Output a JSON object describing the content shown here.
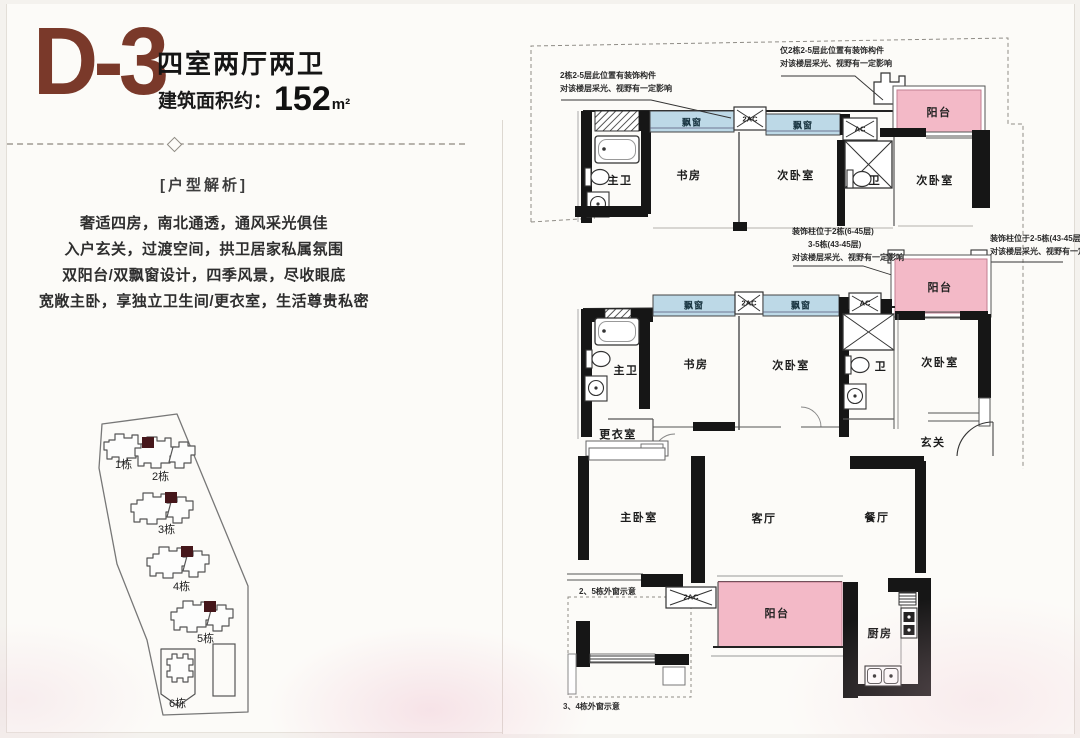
{
  "header": {
    "unit_code": "D-3",
    "unit_type": "四室两厅两卫",
    "area_label": "建筑面积约：",
    "area_value": "152",
    "area_unit": "m²"
  },
  "analysis": {
    "title": "[户型解析]",
    "lines": [
      "奢适四房，南北通透，通风采光俱佳",
      "入户玄关，过渡空间，拱卫居家私属氛围",
      "双阳台/双飘窗设计，四季风景，尽收眼底",
      "宽敞主卧，享独立卫生间/更衣室，生活尊贵私密"
    ]
  },
  "site_plan": {
    "buildings": [
      "1栋",
      "2栋",
      "3栋",
      "4栋",
      "5栋",
      "6栋"
    ]
  },
  "floor_plan": {
    "rooms": {
      "master_bath": "主卫",
      "study": "书房",
      "secondary_bedroom": "次卧室",
      "bath": "卫",
      "balcony": "阳台",
      "dressing_room": "更衣室",
      "foyer": "玄关",
      "master_bedroom": "主卧室",
      "living_room": "客厅",
      "dining_room": "餐厅",
      "kitchen": "厨房"
    },
    "features": {
      "bay_window": "飘窗",
      "ac_double": "2AC",
      "ac": "AC"
    },
    "annotations": {
      "top": [
        "2栋2-5层此位置有装饰构件",
        "对该楼层采光、视野有一定影响"
      ],
      "top_right": [
        "仅2栋2-5层此位置有装饰构件",
        "对该楼层采光、视野有一定影响"
      ],
      "mid_left": [
        "装饰柱位于2栋(6-45层)",
        "3-5栋(43-45层)",
        "对该楼层采光、视野有一定影响"
      ],
      "mid_right": [
        "装饰柱位于2-5栋(43-45层)",
        "对该楼层采光、视野有一定影响"
      ],
      "window_note_25": "2、5栋外窗示意",
      "window_note_34": "3、4栋外窗示意"
    }
  },
  "colors": {
    "accent": "#7a392a",
    "balcony_pink": "#f3b9c7",
    "bay_window_blue": "#bdd9e7",
    "wall": "#161616",
    "dark_unit": "#45161a"
  }
}
